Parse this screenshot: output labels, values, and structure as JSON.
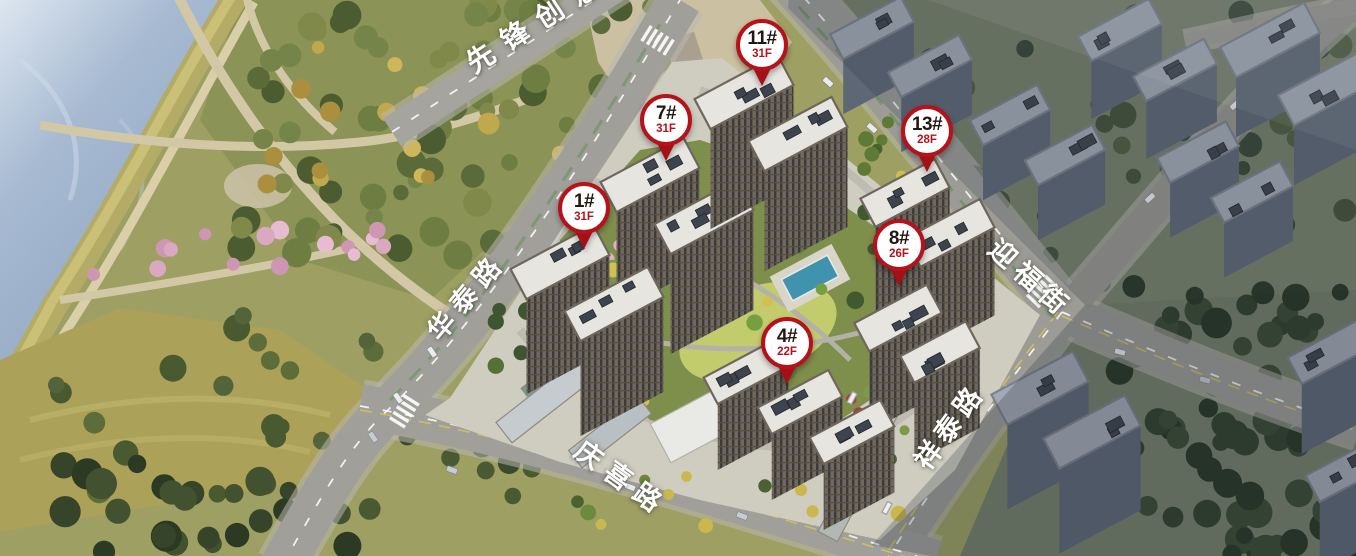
{
  "map": {
    "name": "residential-masterplan-aerial",
    "markers": [
      {
        "id": "11#",
        "floors": "31F",
        "x": 762,
        "y": 45
      },
      {
        "id": "7#",
        "floors": "31F",
        "x": 666,
        "y": 120
      },
      {
        "id": "13#",
        "floors": "28F",
        "x": 927,
        "y": 131
      },
      {
        "id": "1#",
        "floors": "31F",
        "x": 584,
        "y": 208
      },
      {
        "id": "8#",
        "floors": "26F",
        "x": 899,
        "y": 245
      },
      {
        "id": "4#",
        "floors": "22F",
        "x": 787,
        "y": 343
      }
    ],
    "road_labels": [
      {
        "name": "xianfeng-chuangyi",
        "text": "先锋创意",
        "x": 537,
        "y": 20,
        "rotate": -33,
        "size": 28,
        "spacing": 13
      },
      {
        "name": "huatai-road",
        "text": "华泰路",
        "x": 465,
        "y": 295,
        "rotate": -50,
        "size": 27,
        "spacing": 8
      },
      {
        "name": "yingfu-street",
        "text": "迎福街",
        "x": 1032,
        "y": 277,
        "rotate": 42,
        "size": 27,
        "spacing": 7
      },
      {
        "name": "xiangtai-road",
        "text": "祥泰路",
        "x": 948,
        "y": 425,
        "rotate": -54,
        "size": 27,
        "spacing": 6
      },
      {
        "name": "qingxi-road",
        "text": "庆喜路",
        "x": 623,
        "y": 477,
        "rotate": 36,
        "size": 27,
        "spacing": 9
      }
    ],
    "colors": {
      "pin_border": "#b5121c",
      "pin_fill": "#ffffff",
      "pin_id_text": "#231713",
      "pin_floor_text": "#b5121c",
      "pin_tail": "#a31016",
      "road_label_text": "#ffffff"
    }
  }
}
